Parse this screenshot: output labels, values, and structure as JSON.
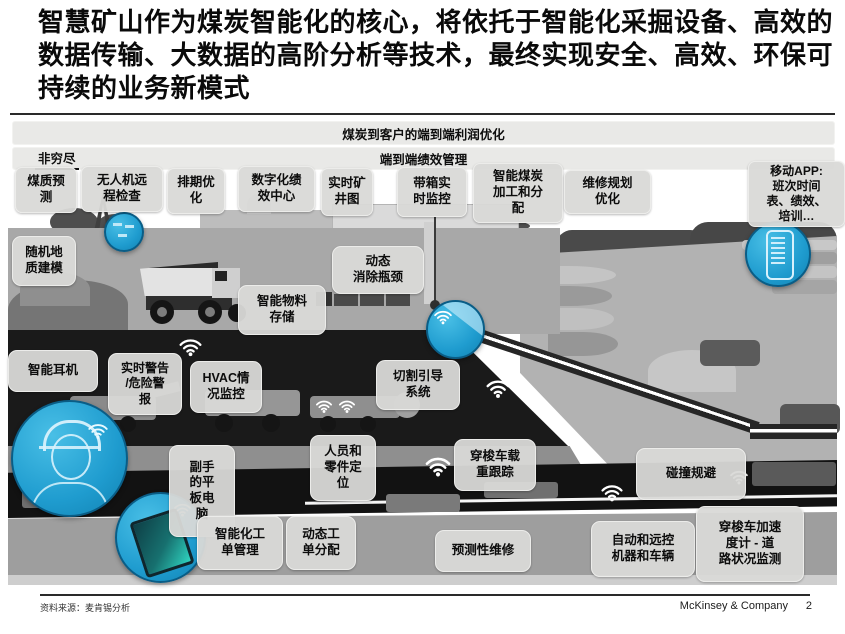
{
  "slide": {
    "title": "智慧矿山作为煤炭智能化的核心，将依托于智能化采掘设备、高效的数据传输、大数据的高阶分析等技术，最终实现安全、高效、环保可持续的业务新模式",
    "footer": {
      "source": "资料来源：麦肯锡分析",
      "brand": "McKinsey & Company",
      "page_number": "2"
    }
  },
  "banners": {
    "profit": "煤炭到客户的端到端利润优化",
    "performance": "端到端绩效管理",
    "not_exhaustive": "非穷尽"
  },
  "top_row": [
    {
      "label": "煤质预\n测"
    },
    {
      "label": "无人机远\n程检查"
    },
    {
      "label": "排期优\n化"
    },
    {
      "label": "数字化绩\n效中心"
    },
    {
      "label": "实时矿\n井图"
    },
    {
      "label": "带箱实\n时监控"
    },
    {
      "label": "智能煤炭\n加工和分\n配"
    },
    {
      "label": "维修规划\n优化"
    },
    {
      "label": "移动APP:\n班次时间\n表、绩效、\n培训…"
    }
  ],
  "callouts": [
    {
      "label": "随机地\n质建模"
    },
    {
      "label": "动态\n消除瓶颈"
    },
    {
      "label": "智能物料\n存储"
    },
    {
      "label": "智能耳机"
    },
    {
      "label": "实时警告\n/危险警\n报"
    },
    {
      "label": "HVAC情\n况监控"
    },
    {
      "label": "切割引导\n系统"
    },
    {
      "label": "人员和\n零件定\n位"
    },
    {
      "label": "穿梭车载\n重跟踪"
    },
    {
      "label": "碰撞规避"
    },
    {
      "label": "副手\n的平\n板电\n脑"
    },
    {
      "label": "智能化工\n单管理"
    },
    {
      "label": "动态工\n单分配"
    },
    {
      "label": "预测性维修"
    },
    {
      "label": "自动和远控\n机器和车辆"
    },
    {
      "label": "穿梭车加速\n度计 - 道\n路状况监测"
    }
  ],
  "icons": {
    "wifi": "wifi-signal-arcs",
    "highlights": [
      "drone",
      "conveyor",
      "smartphone",
      "miner-helmet",
      "tablet"
    ]
  },
  "colors": {
    "highlight_blue": "#2BA9DB",
    "highlight_blue_dark": "#0A5D86",
    "box_gray": "#D9D9D7",
    "banner_gray": "#E9E9E7"
  }
}
